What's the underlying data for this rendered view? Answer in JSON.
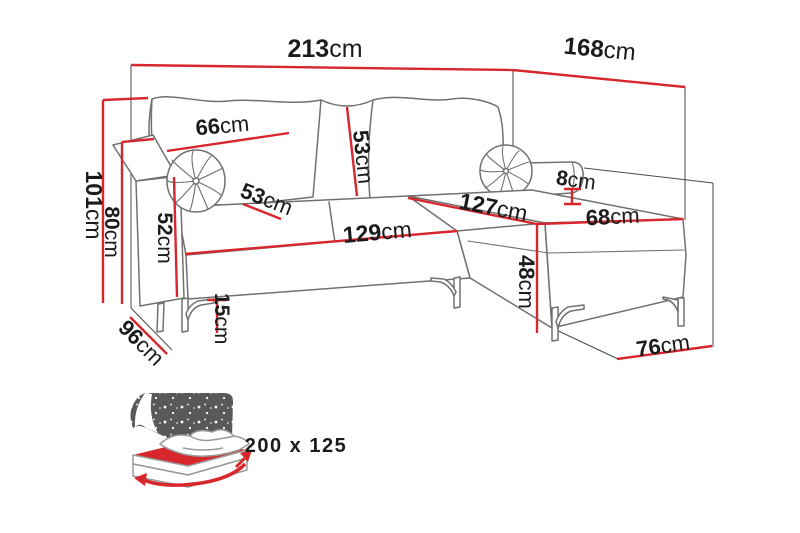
{
  "diagram": {
    "dimensions": {
      "total_width": {
        "value": "213",
        "unit": "cm"
      },
      "total_depth": {
        "value": "168",
        "unit": "cm"
      },
      "back_cushion_width": {
        "value": "66",
        "unit": "cm"
      },
      "back_cushion_height": {
        "value": "53",
        "unit": "cm"
      },
      "total_height": {
        "value": "101",
        "unit": "cm"
      },
      "backrest_height": {
        "value": "80",
        "unit": "cm"
      },
      "armrest_height": {
        "value": "52",
        "unit": "cm"
      },
      "seat_cushion_depth": {
        "value": "53",
        "unit": "cm"
      },
      "seat_front_width": {
        "value": "129",
        "unit": "cm"
      },
      "chaise_seat_length": {
        "value": "127",
        "unit": "cm"
      },
      "side_pad_thickness": {
        "value": "8",
        "unit": "cm"
      },
      "chaise_seat_width": {
        "value": "68",
        "unit": "cm"
      },
      "seat_height": {
        "value": "48",
        "unit": "cm"
      },
      "sofa_depth": {
        "value": "96",
        "unit": "cm"
      },
      "leg_height": {
        "value": "15",
        "unit": "cm"
      },
      "chaise_end_width": {
        "value": "76",
        "unit": "cm"
      }
    },
    "sleeping_function": {
      "size_label": "200 x 125"
    },
    "colors": {
      "dimension_red": "#d7262c",
      "outline_gray": "#707070",
      "construction_gray": "#4a4a4a",
      "label_black": "#1b1b1b",
      "icon_dark_gray": "#58595b",
      "icon_text_gray": "#55565a"
    }
  }
}
